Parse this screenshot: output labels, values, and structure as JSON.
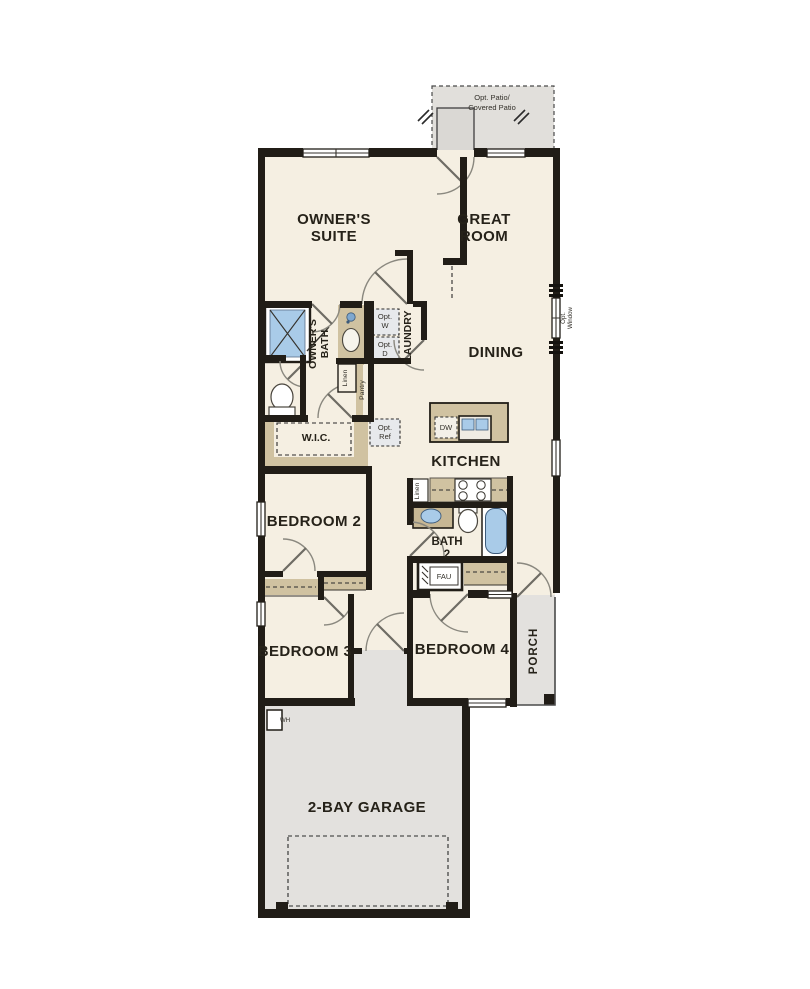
{
  "plan_type": "floor-plan",
  "labels": {
    "patio1": "Opt. Patio/",
    "patio2": "Covered Patio",
    "suite1": "OWNER'S",
    "suite2": "SUITE",
    "great1": "GREAT",
    "great2": "ROOM",
    "dining": "DINING",
    "kitchen": "KITCHEN",
    "obath1": "OWNER'S",
    "obath2": "BATH",
    "laundry": "LAUNDRY",
    "optw1": "Opt.",
    "optw2": "W",
    "optd1": "Opt.",
    "optd2": "D",
    "linen": "Linen",
    "pantry": "Pantry",
    "wic": "W.I.C.",
    "optref1": "Opt.",
    "optref2": "Ref",
    "dw": "DW",
    "optwin1": "Opt.",
    "optwin2": "Window",
    "bedroom2": "BEDROOM 2",
    "bath21": "BATH",
    "bath22": "2",
    "linen2": "Linen",
    "fau": "FAU",
    "bedroom3": "BEDROOM 3",
    "bedroom4": "BEDROOM 4",
    "porch": "PORCH",
    "garage": "2-BAY GARAGE",
    "wh": "WH"
  },
  "fixtures": [
    "shower",
    "vanity-sink",
    "toilet",
    "washer-dryer-opt",
    "refrigerator-opt",
    "kitchen-island",
    "island-double-sink",
    "dishwasher",
    "range-stove",
    "bath2-sink",
    "bath2-toilet",
    "bathtub",
    "fau-unit",
    "water-heater",
    "garage-door",
    "porch-post"
  ],
  "colors": {
    "wall": "#211d17",
    "floor": "#f5efe2",
    "gray_area": "#e3e1de",
    "tan_counter": "#d0c2a1",
    "fixture_blue": "#a9cbe8",
    "background": "#ffffff"
  }
}
